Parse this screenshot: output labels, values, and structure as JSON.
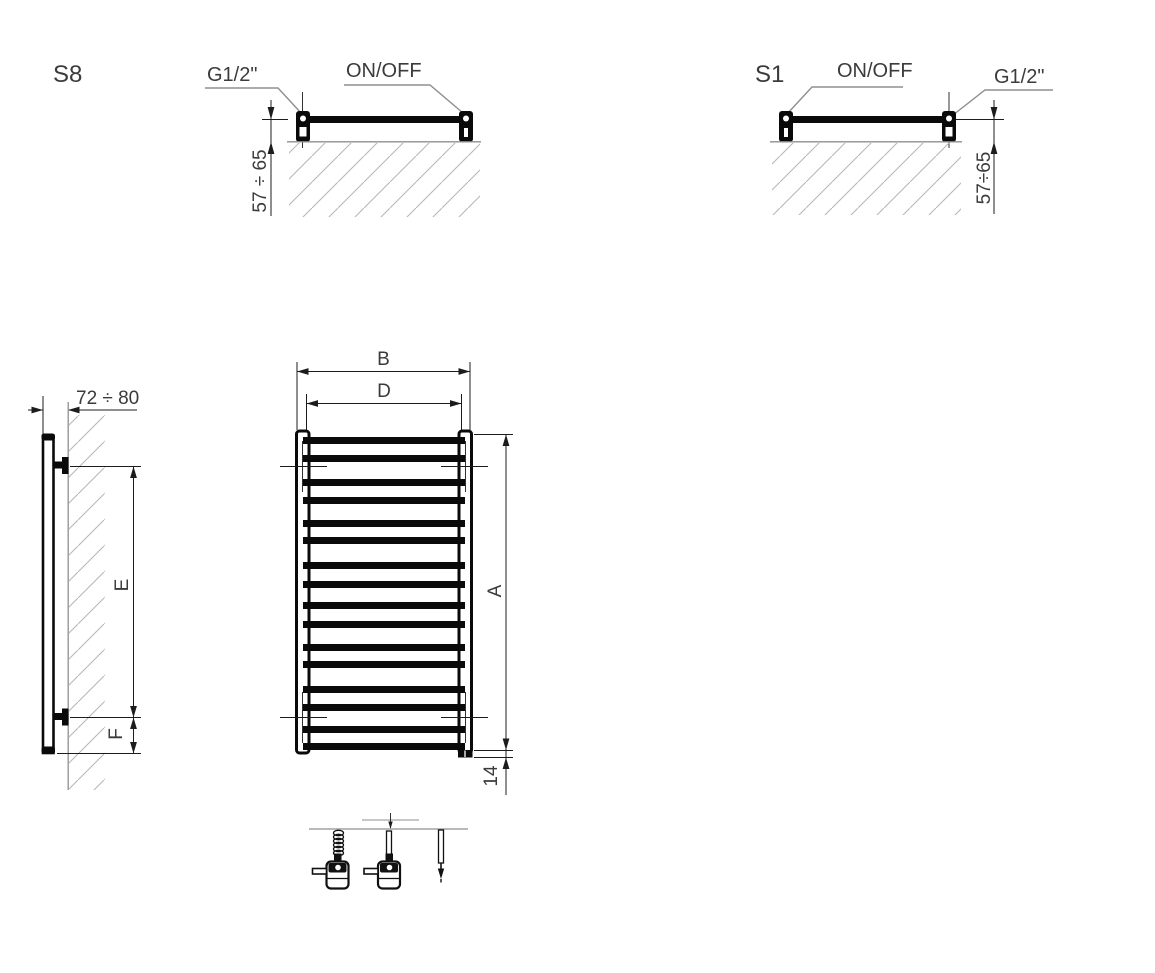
{
  "document": {
    "type": "technical-drawing",
    "subject": "towel radiator dimension diagram"
  },
  "colors": {
    "line": "#0a0a0a",
    "thin_line": "#1c1c1c",
    "leader": "#8f8f8f",
    "wall": "#8f8f8f",
    "hatch": "#b8b8b8",
    "text": "#3b3b3b"
  },
  "views": {
    "top_view_s8": {
      "title": "S8",
      "thread_label": "G1/2\"",
      "switch_label": "ON/OFF",
      "wall_distance_label": "57 ÷ 65"
    },
    "top_view_s1": {
      "title": "S1",
      "switch_label": "ON/OFF",
      "thread_label": "G1/2\"",
      "wall_distance_label": "57÷65"
    },
    "side_view": {
      "depth_label": "72 ÷ 80",
      "upper_span_label": "E",
      "lower_span_label": "F"
    },
    "front_view": {
      "outer_width_label": "B",
      "inner_width_label": "D",
      "height_label": "A",
      "bottom_offset_label": "14"
    }
  }
}
